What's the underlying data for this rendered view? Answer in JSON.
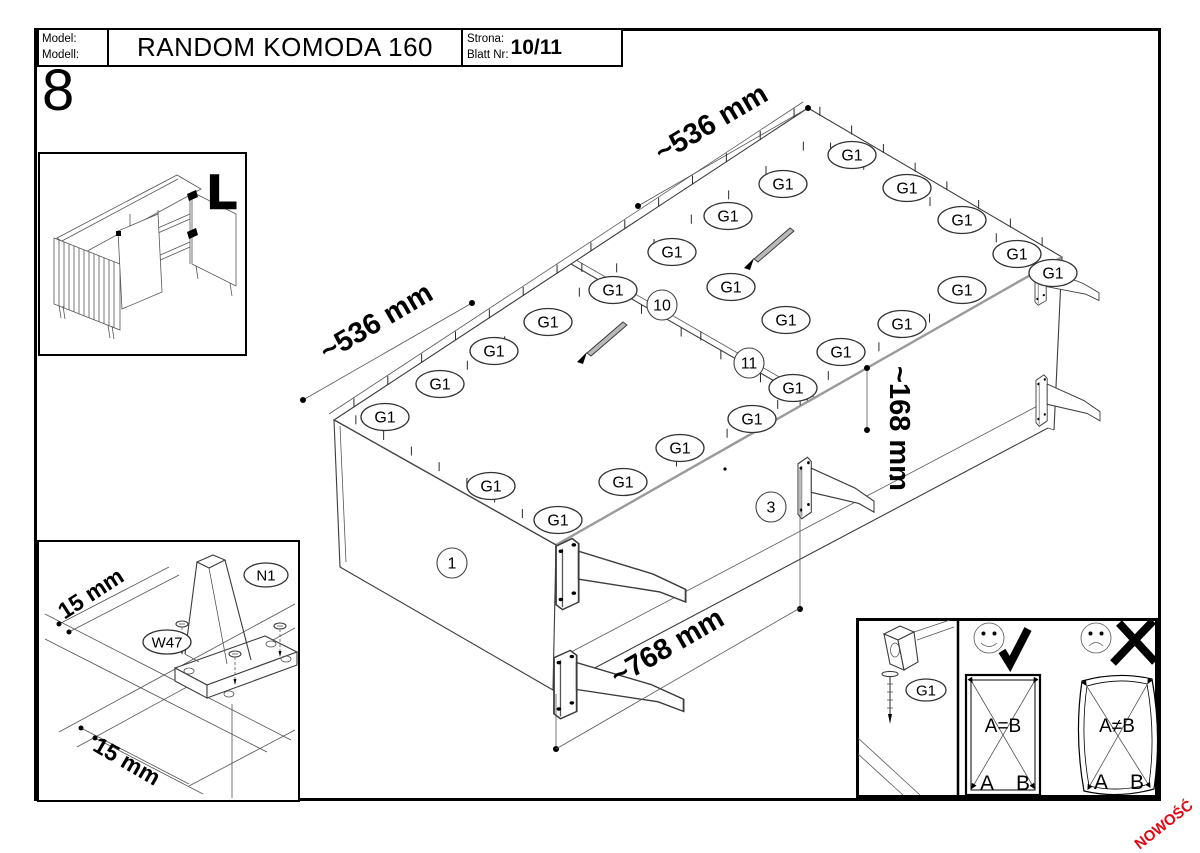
{
  "header": {
    "model_label_line1": "Model:",
    "model_label_line2": "Modell:",
    "model_value": "RANDOM KOMODA 160",
    "page_label_line1": "Strona:",
    "page_label_line2": "Blatt Nr:",
    "page_value": "10/11"
  },
  "step_number": "8",
  "inset_overview": {
    "corner_letter": "L"
  },
  "diagram": {
    "g1_label": "G1",
    "parts": {
      "side_panel": "1",
      "bottom_rail": "3",
      "back_panel_left": "10",
      "back_panel_right": "11"
    },
    "dims": {
      "top_right": "~536 mm",
      "top_left": "~536 mm",
      "height": "~168 mm",
      "bottom": "~768 mm"
    }
  },
  "inset_leg": {
    "leg_label": "N1",
    "screw_label": "W47",
    "dim_top": "15 mm",
    "dim_bottom": "15 mm"
  },
  "check_panel": {
    "nail_label": "G1",
    "ok": {
      "equation": "A=B",
      "corner_a": "A",
      "corner_b": "B"
    },
    "bad": {
      "equation": "A≠B",
      "corner_a": "A",
      "corner_b": "B"
    }
  },
  "footer": {
    "new_badge": "NOWOŚĆ",
    "badge_color": "#e30613"
  }
}
